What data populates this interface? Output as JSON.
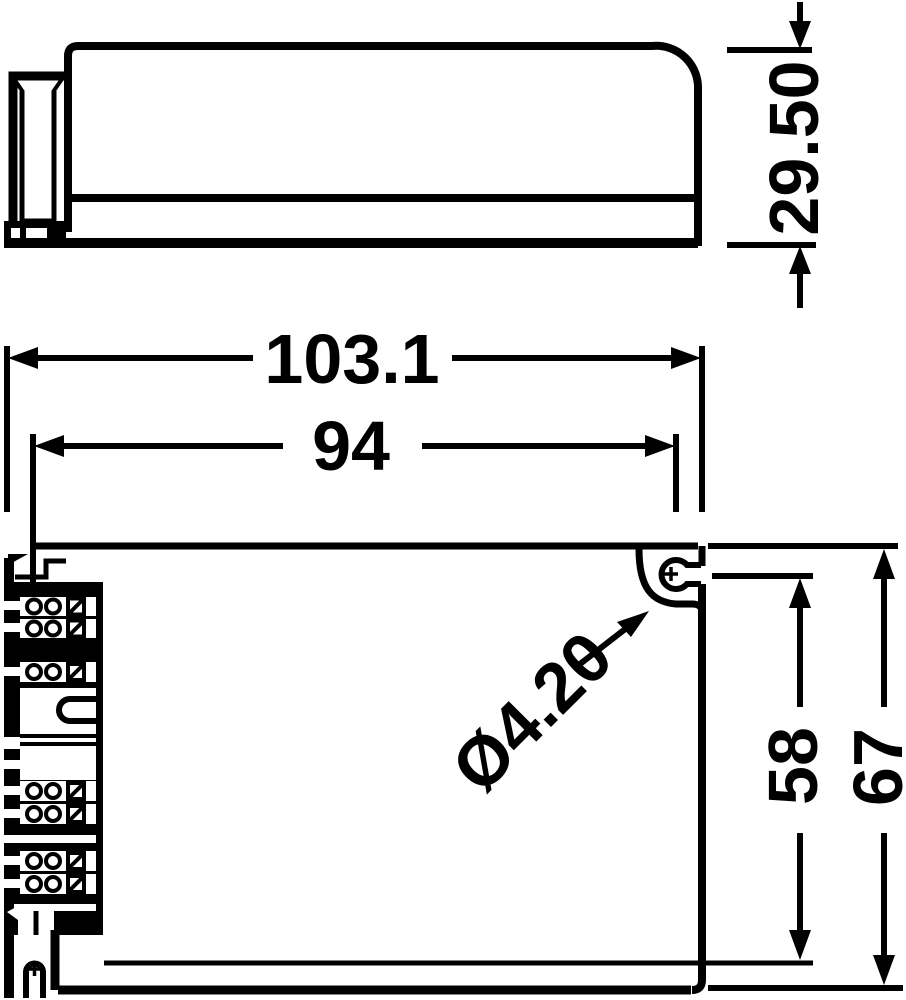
{
  "drawing": {
    "kind": "technical-dimension-drawing",
    "views": [
      "side-view",
      "top-view"
    ],
    "colors": {
      "ink": "#000000",
      "paper": "#ffffff"
    }
  },
  "dimensions": {
    "side_height": "29.50",
    "overall_width": "103.1",
    "mounting_width": "94",
    "hole_diameter": "Ø4.20",
    "mounting_height": "58",
    "overall_height": "67"
  }
}
